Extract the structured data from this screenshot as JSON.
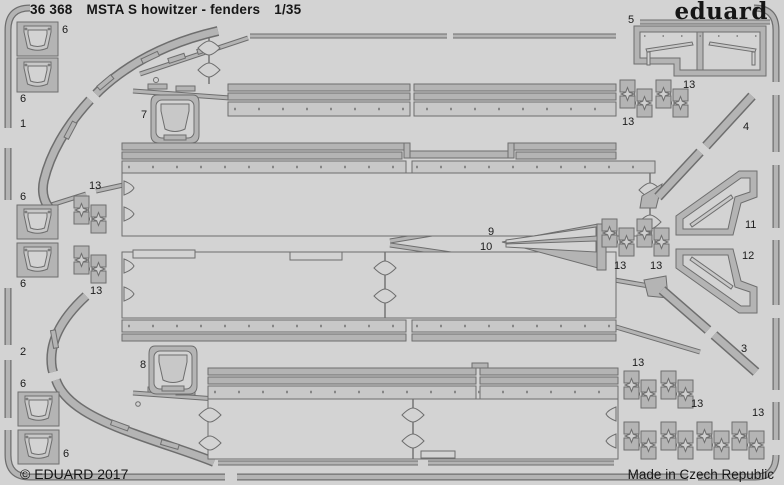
{
  "header": {
    "sheet_number": "36 368",
    "title": "MSTA S howitzer - fenders",
    "scale": "1/35",
    "brand": "eduard"
  },
  "footer": {
    "copyright": "© EDUARD 2017",
    "origin": "Made in Czech Republic"
  },
  "colors": {
    "background": "#d3d3d3",
    "metal": "#b4b4b4",
    "metal_light": "#c8c8c8",
    "outline": "#6e6e6e",
    "text": "#161616"
  },
  "part_labels": [
    {
      "n": "1",
      "x": 20,
      "y": 118
    },
    {
      "n": "2",
      "x": 20,
      "y": 346
    },
    {
      "n": "3",
      "x": 741,
      "y": 343
    },
    {
      "n": "4",
      "x": 743,
      "y": 121
    },
    {
      "n": "5",
      "x": 628,
      "y": 14
    },
    {
      "n": "6",
      "x": 62,
      "y": 24
    },
    {
      "n": "6",
      "x": 20,
      "y": 93
    },
    {
      "n": "6",
      "x": 20,
      "y": 191
    },
    {
      "n": "6",
      "x": 20,
      "y": 278
    },
    {
      "n": "6",
      "x": 20,
      "y": 378
    },
    {
      "n": "6",
      "x": 63,
      "y": 448
    },
    {
      "n": "7",
      "x": 141,
      "y": 109
    },
    {
      "n": "8",
      "x": 140,
      "y": 359
    },
    {
      "n": "9",
      "x": 488,
      "y": 226
    },
    {
      "n": "10",
      "x": 480,
      "y": 241
    },
    {
      "n": "11",
      "x": 745,
      "y": 219
    },
    {
      "n": "12",
      "x": 742,
      "y": 250
    },
    {
      "n": "13",
      "x": 89,
      "y": 180
    },
    {
      "n": "13",
      "x": 90,
      "y": 285
    },
    {
      "n": "13",
      "x": 683,
      "y": 79
    },
    {
      "n": "13",
      "x": 622,
      "y": 116
    },
    {
      "n": "13",
      "x": 614,
      "y": 260
    },
    {
      "n": "13",
      "x": 650,
      "y": 260
    },
    {
      "n": "13",
      "x": 632,
      "y": 357
    },
    {
      "n": "13",
      "x": 691,
      "y": 398
    },
    {
      "n": "13",
      "x": 752,
      "y": 407
    }
  ]
}
